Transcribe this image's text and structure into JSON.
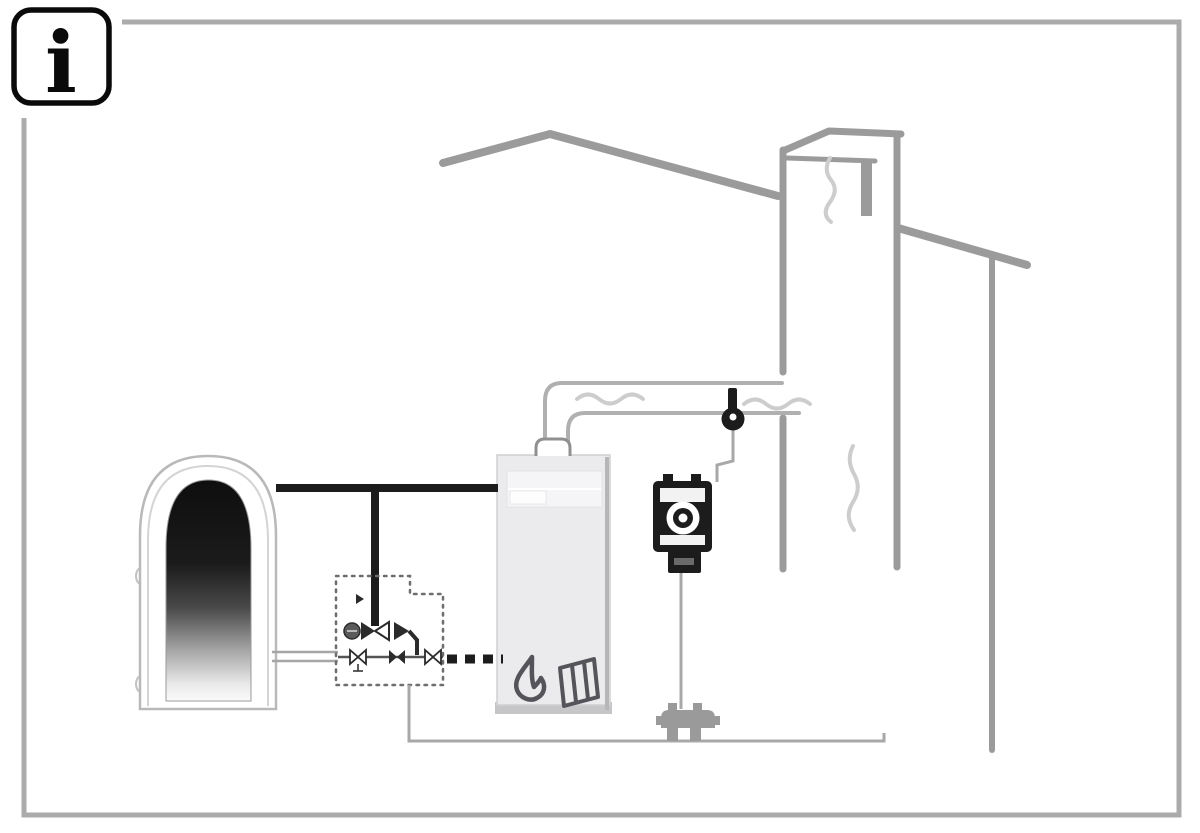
{
  "figure": {
    "info_symbol": "i",
    "description": "Installation illustration: heat storage tank, mixing valve group, solid fuel boiler, flue gas sensor, draft fan and chimney under a roof"
  },
  "icons": {
    "info": "info-icon",
    "flame": "flame-icon",
    "firewood": "firewood-icon",
    "plug": "power-plug-icon",
    "sensor": "flue-gas-sensor-icon"
  },
  "colors": {
    "background": "#ffffff",
    "frame": "#ababab",
    "outline_black": "#0a0a0a",
    "structure_gray": "#9b9b9b",
    "duct_gray": "#b0b0b0",
    "smoke_gray": "#cdcdcd",
    "pipe_black": "#1c1c1c",
    "wire_gray": "#a8a8a8",
    "boiler_fill": "#ebebee",
    "boiler_shade": "#b6b6b9",
    "panel_fill": "#f5f5f7",
    "icon_gray": "#54545a",
    "tank_outline": "#b9b9b9",
    "valve_dark": "#2b2b2b",
    "plug_gray": "#9a9a9a"
  }
}
